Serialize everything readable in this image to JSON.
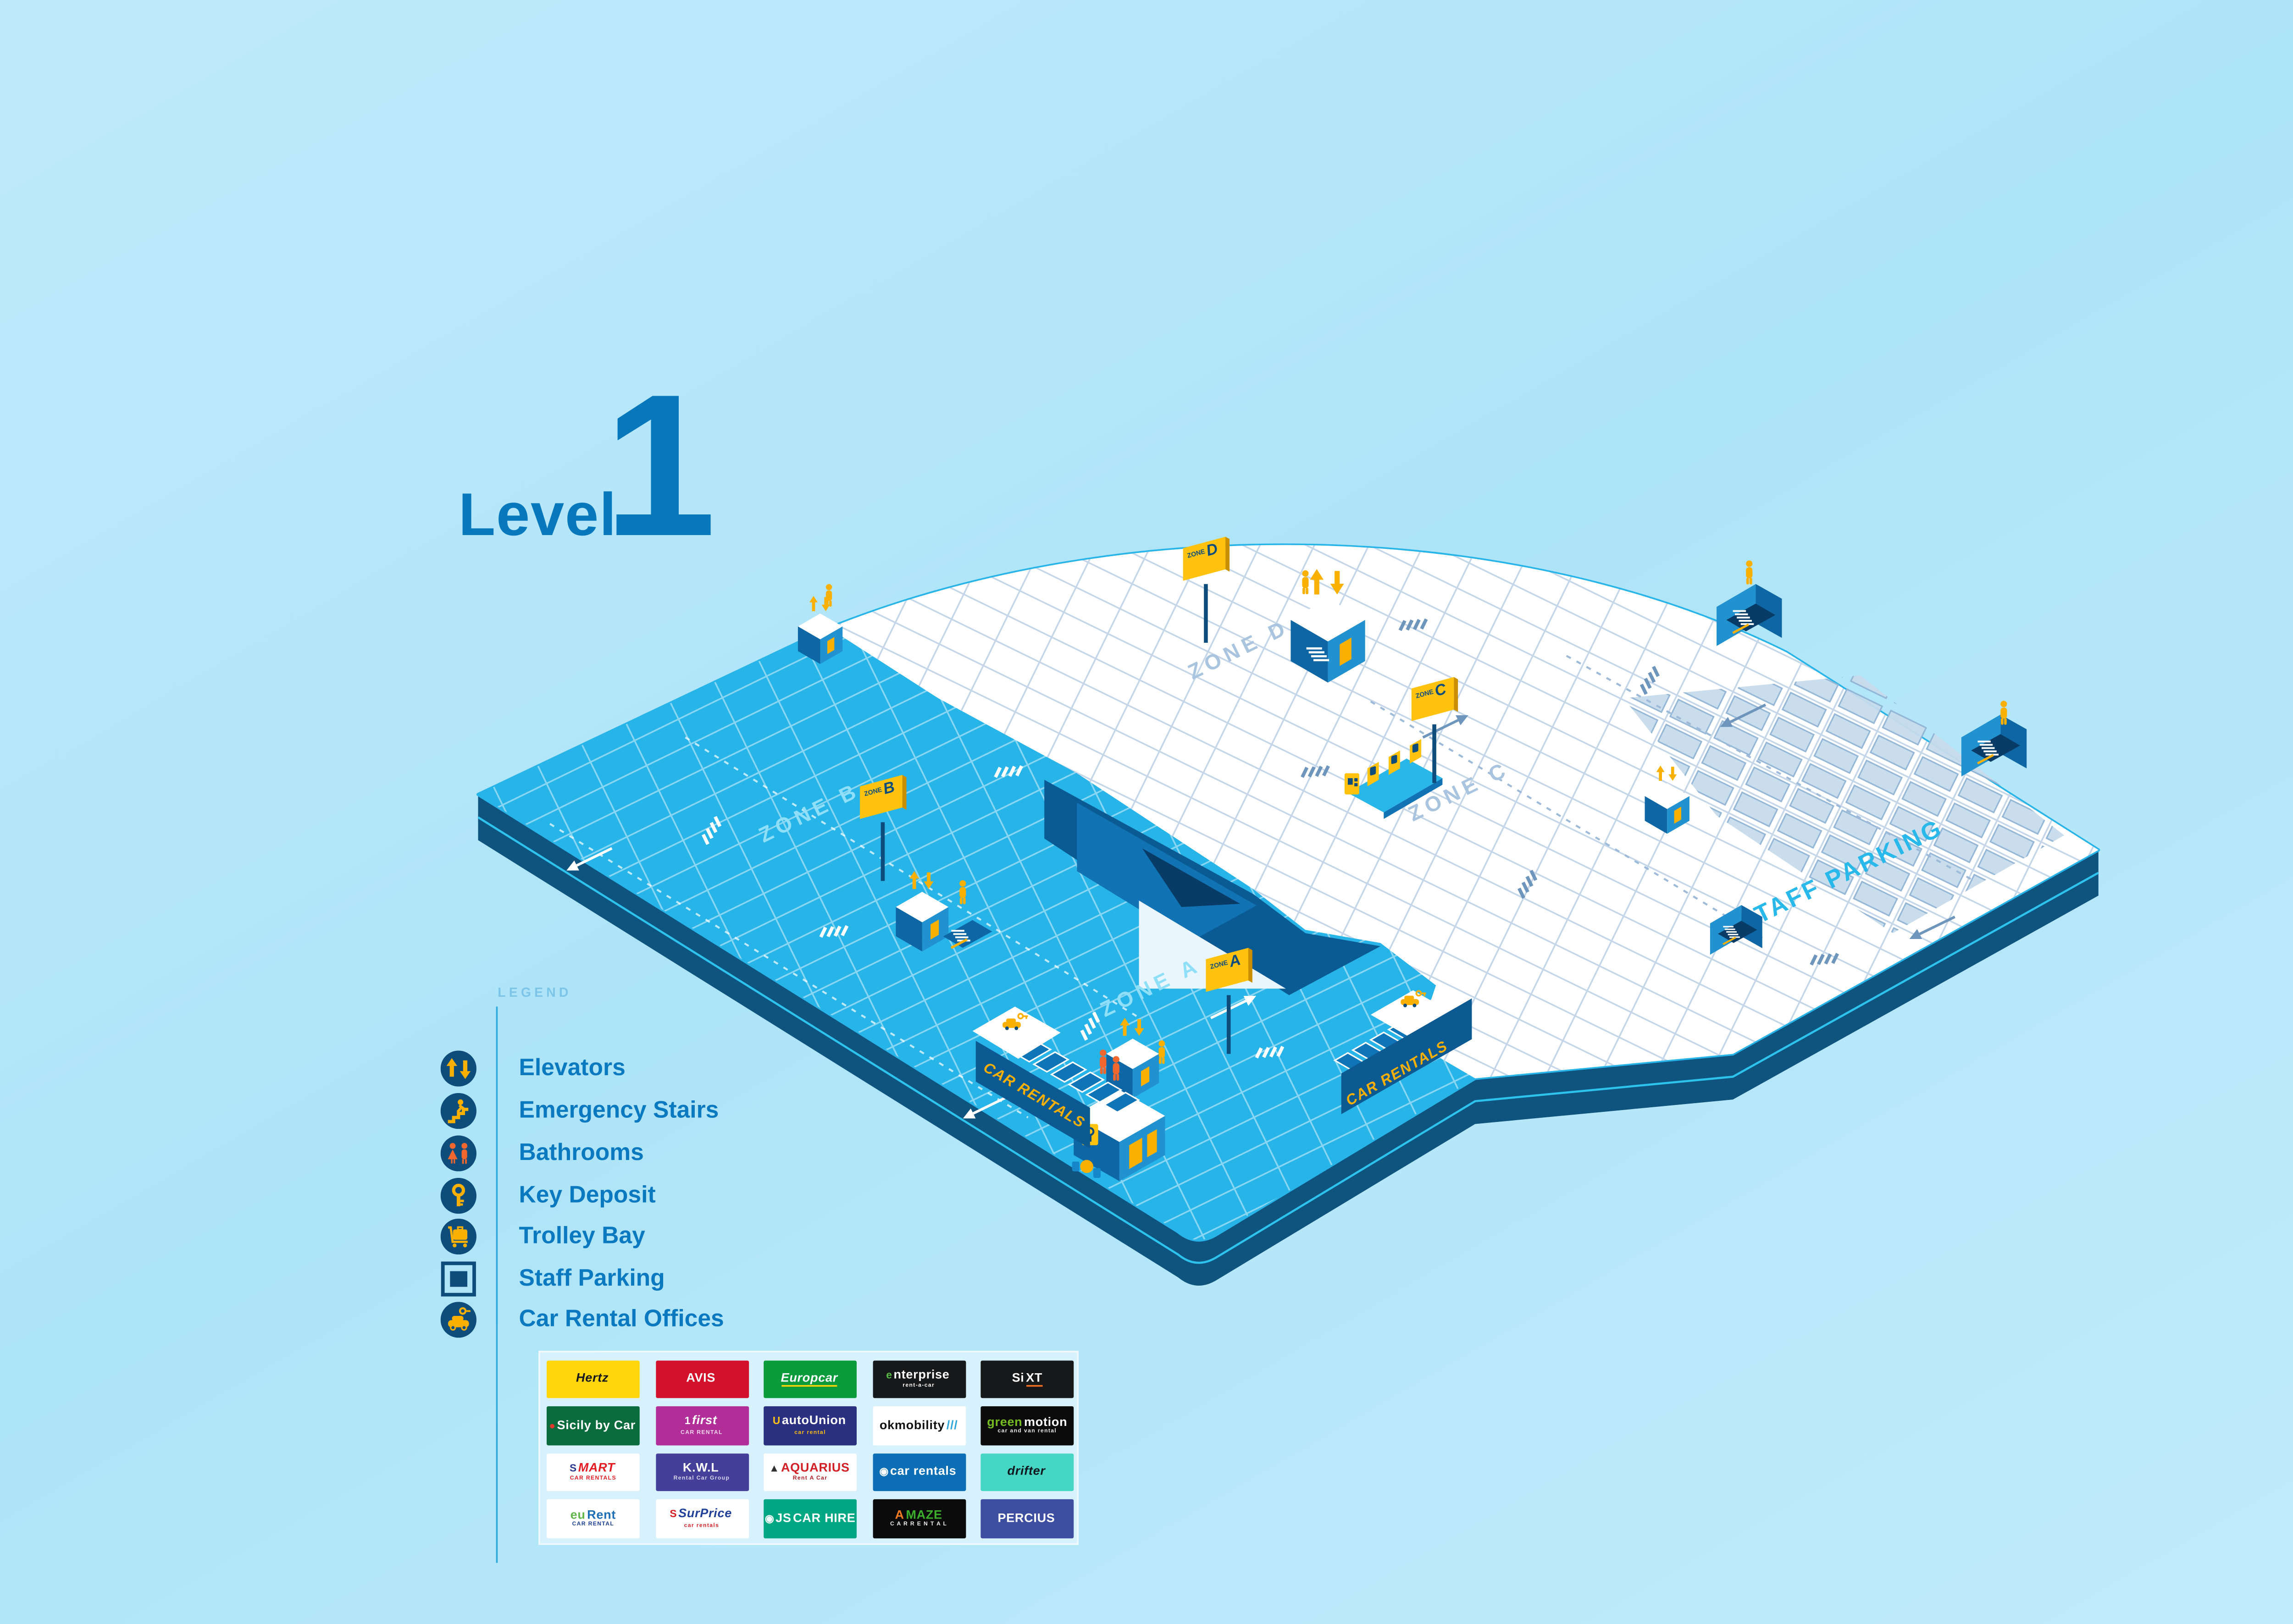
{
  "title": {
    "word": "Level",
    "number": "1"
  },
  "legend": {
    "title": "LEGEND",
    "items": [
      {
        "icon": "elevators-icon",
        "label": "Elevators"
      },
      {
        "icon": "emergency-stairs-icon",
        "label": "Emergency Stairs"
      },
      {
        "icon": "bathrooms-icon",
        "label": "Bathrooms"
      },
      {
        "icon": "key-deposit-icon",
        "label": "Key Deposit"
      },
      {
        "icon": "trolley-bay-icon",
        "label": "Trolley Bay"
      },
      {
        "icon": "staff-parking-icon",
        "label": "Staff Parking"
      },
      {
        "icon": "car-rental-offices-icon",
        "label": "Car Rental Offices"
      }
    ]
  },
  "map": {
    "zones": [
      {
        "letter": "A",
        "floor_label": "ZONE A",
        "sign_word": "ZONE",
        "sign_letter": "A"
      },
      {
        "letter": "B",
        "floor_label": "ZONE B",
        "sign_word": "ZONE",
        "sign_letter": "B"
      },
      {
        "letter": "C",
        "floor_label": "ZONE C",
        "sign_word": "ZONE",
        "sign_letter": "C"
      },
      {
        "letter": "D",
        "floor_label": "ZONE D",
        "sign_word": "ZONE",
        "sign_letter": "D"
      }
    ],
    "staff_parking_label": "STAFF PARKING",
    "car_rentals_left": "CAR RENTALS",
    "car_rentals_right": "CAR RENTALS"
  },
  "colors": {
    "background": "#B7E7FA",
    "floor_blue": "#27B4E8",
    "floor_white": "#FFFFFF",
    "platform_edge": "#0F537F",
    "edge_stripe": "#2FC9F2",
    "accent_yellow": "#F9B000",
    "sign_yellow": "#FFC20E",
    "people_orange": "#F2672D",
    "legend_text": "#0B79BF",
    "title_text": "#0878BD",
    "staff_label": "#29B8EA",
    "zone_label_on_blue": "#8EDFF7",
    "zone_label_on_white": "#A9C4DE"
  },
  "logos": [
    {
      "name": "Hertz",
      "label": "Hertz",
      "bg": "#FFD60A",
      "fg": "#16181C",
      "italic": true
    },
    {
      "name": "Avis",
      "label": "AVIS",
      "bg": "#D4112B",
      "fg": "#FFFFFF"
    },
    {
      "name": "Europcar",
      "label": "Europcar",
      "bg": "#0C9B3B",
      "fg": "#FFFFFF",
      "italic": true,
      "accent": "#FFD400"
    },
    {
      "name": "Enterprise",
      "icon": "e",
      "icon_color": "#59B947",
      "label": "nterprise",
      "fg": "#FFFFFF",
      "bg": "#17181A",
      "sub": "rent-a-car",
      "sub_color": "#FFFFFF"
    },
    {
      "name": "Sixt",
      "label": "Si",
      "fg": "#FFFFFF",
      "label2": "XT",
      "fg2": "#FFFFFF",
      "bg": "#17181A",
      "accent": "#F26F21",
      "accent_on": "label2"
    },
    {
      "name": "Sicily by Car",
      "icon": "●",
      "icon_color": "#E2372C",
      "label": "Sicily by Car",
      "fg": "#FFFFFF",
      "bg": "#0A6B3C"
    },
    {
      "name": "First Car Rental",
      "icon": "1",
      "icon_color": "#FFFFFF",
      "label": "first",
      "fg": "#FFFFFF",
      "bg": "#B12D97",
      "italic": true,
      "sub": "CAR RENTAL",
      "sub_color": "#F3D9EF"
    },
    {
      "name": "autoUnion Car Rental",
      "icon": "U",
      "icon_color": "#FFC20E",
      "label": "autoUnion",
      "fg": "#FFFFFF",
      "bg": "#2A2F80",
      "sub": "car rental",
      "sub_color": "#FFC20E"
    },
    {
      "name": "OK Mobility",
      "label": "okmobility",
      "fg": "#121212",
      "label2": "///",
      "fg2": "#2FA6DB",
      "bg": "#FFFFFF"
    },
    {
      "name": "Green Motion",
      "label": "green",
      "fg": "#76BC21",
      "label2": "motion",
      "fg2": "#FFFFFF",
      "bg": "#0B0B0B",
      "sub": "car and van rental",
      "sub_color": "#E8E8E8"
    },
    {
      "name": "Smart Car Rentals",
      "icon": "S",
      "icon_color": "#2B3990",
      "label": "MART",
      "fg": "#E31B23",
      "bg": "#FFFFFF",
      "italic": true,
      "sub": "CAR RENTALS",
      "sub_color": "#E31B23"
    },
    {
      "name": "K.W.L Rental Car Group",
      "label": "K.W.L",
      "fg": "#FFFFFF",
      "bg": "#443F99",
      "sub": "Rental Car Group",
      "sub_color": "#D9D7F0"
    },
    {
      "name": "Aquarius Rent A Car",
      "icon": "▲",
      "icon_color": "#2F2F2F",
      "label": "AQUARIUS",
      "fg": "#D21F26",
      "bg": "#FFFFFF",
      "sub": "Rent A Car",
      "sub_color": "#B01E23"
    },
    {
      "name": "Car Rentals",
      "icon": "◉",
      "icon_color": "#FFFFFF",
      "label": "car rentals",
      "fg": "#FFFFFF",
      "bg": "#0C6FB5"
    },
    {
      "name": "Drifter",
      "label": "drifter",
      "fg": "#10181E",
      "bg": "#45D6C4",
      "italic": true
    },
    {
      "name": "euRent Car Rental",
      "label": "eu",
      "fg": "#62B64C",
      "label2": "Rent",
      "fg2": "#1D6FB8",
      "bg": "#FFFFFF",
      "sub": "CAR RENTAL",
      "sub_color": "#1B3F94"
    },
    {
      "name": "SurPrice Car Rentals",
      "icon": "S",
      "icon_color": "#D71F27",
      "label": "SurPrice",
      "fg": "#21409A",
      "bg": "#FFFFFF",
      "italic": true,
      "sub": "car rentals",
      "sub_color": "#D71F27"
    },
    {
      "name": "JS Car Hire",
      "icon": "◉",
      "icon_color": "#FFFFFF",
      "label": "JS",
      "fg": "#FFFFFF",
      "label2": "CAR HIRE",
      "fg2": "#FFFFFF",
      "bg": "#00A783"
    },
    {
      "name": "Amaze Car Rental",
      "label": "A",
      "fg": "#F47B20",
      "label2": "MAZE",
      "fg2": "#3DAE2B",
      "bg": "#0B0B0B",
      "sub": "C A R   R E N T A L",
      "sub_color": "#EFEFEF"
    },
    {
      "name": "Percius",
      "label": "PERCIUS",
      "fg": "#FFFFFF",
      "bg": "#3D4EA1"
    }
  ]
}
